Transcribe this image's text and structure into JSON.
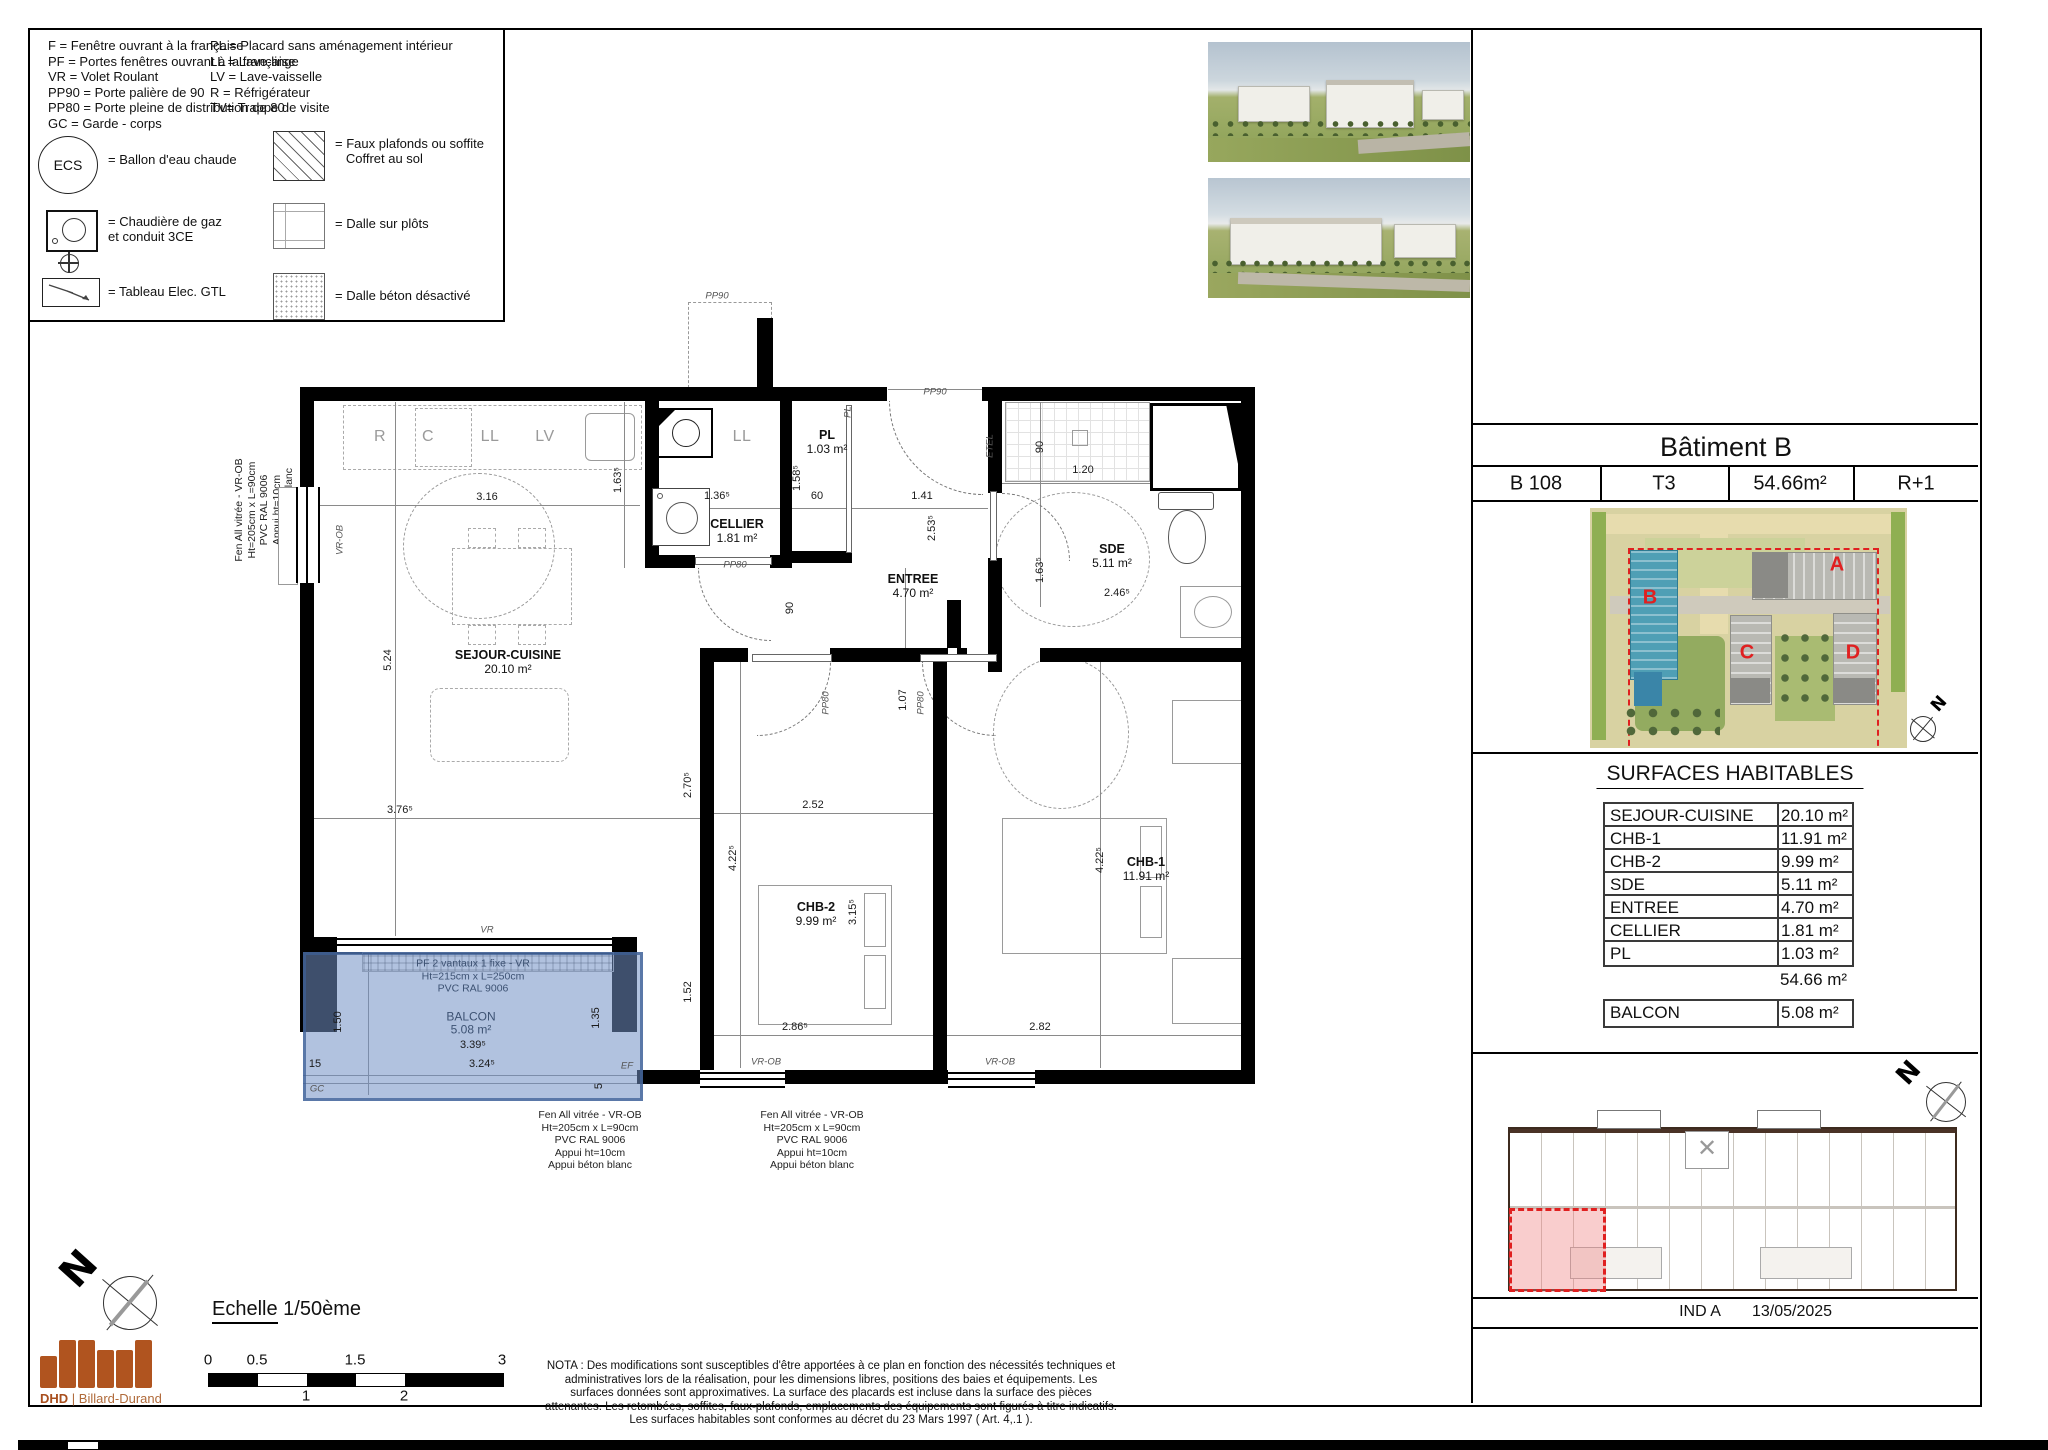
{
  "legend": {
    "abbrev_left": "F = Fenêtre ouvrant à la française\nPF = Portes fenêtres ouvrant à la française\nVR = Volet Roulant\nPP90 = Porte palière de 90\nPP80 = Porte pleine de distribution de 80\nGC = Garde - corps",
    "abbrev_right": "PL = Placard sans aménagement intérieur\nLL = Lave-linge\nLV = Lave-vaisselle\nR = Réfrigérateur\nTV= Trappe de visite",
    "ecs": "ECS",
    "ecs_label": "= Ballon d'eau chaude",
    "boiler_label": "= Chaudière de gaz\net conduit 3CE",
    "elec_label": "= Tableau Elec. GTL",
    "faux_label": "= Faux plafonds ou soffite\n   Coffret au sol",
    "plots_label": "= Dalle sur plôts",
    "beton_label": "= Dalle béton désactivé"
  },
  "plan": {
    "rooms": [
      {
        "name": "SEJOUR-CUISINE",
        "area": "20.10 m²",
        "x": 508,
        "y": 662
      },
      {
        "name": "CELLIER",
        "area": "1.81 m²",
        "x": 737,
        "y": 531
      },
      {
        "name": "PL",
        "area": "1.03 m²",
        "x": 827,
        "y": 442
      },
      {
        "name": "ENTREE",
        "area": "4.70 m²",
        "x": 913,
        "y": 586
      },
      {
        "name": "SDE",
        "area": "5.11 m²",
        "x": 1112,
        "y": 556
      },
      {
        "name": "CHB-2",
        "area": "9.99 m²",
        "x": 816,
        "y": 914
      },
      {
        "name": "CHB-1",
        "area": "11.91 m²",
        "x": 1146,
        "y": 869
      }
    ],
    "dims": [
      {
        "t": "3.16",
        "x": 487,
        "y": 497,
        "r": 0
      },
      {
        "t": "1.63⁵",
        "x": 618,
        "y": 480,
        "r": 1
      },
      {
        "t": "5.24",
        "x": 388,
        "y": 660,
        "r": 1
      },
      {
        "t": "3.76⁵",
        "x": 400,
        "y": 810,
        "r": 0
      },
      {
        "t": "2.70⁵",
        "x": 688,
        "y": 785,
        "r": 1
      },
      {
        "t": "2.52",
        "x": 813,
        "y": 805,
        "r": 0
      },
      {
        "t": "4.22⁵",
        "x": 733,
        "y": 858,
        "r": 1
      },
      {
        "t": "3.15⁵",
        "x": 853,
        "y": 912,
        "r": 1
      },
      {
        "t": "2.86⁵",
        "x": 795,
        "y": 1027,
        "r": 0
      },
      {
        "t": "1.52",
        "x": 688,
        "y": 992,
        "r": 1
      },
      {
        "t": "2.82",
        "x": 1040,
        "y": 1027,
        "r": 0
      },
      {
        "t": "4.22⁵",
        "x": 1100,
        "y": 860,
        "r": 1
      },
      {
        "t": "1.07",
        "x": 903,
        "y": 700,
        "r": 1
      },
      {
        "t": "90",
        "x": 790,
        "y": 608,
        "r": 1
      },
      {
        "t": "90",
        "x": 1040,
        "y": 447,
        "r": 1
      },
      {
        "t": "1.20",
        "x": 1083,
        "y": 470,
        "r": 0
      },
      {
        "t": "1.63⁵",
        "x": 1040,
        "y": 570,
        "r": 1
      },
      {
        "t": "2.46⁵",
        "x": 1117,
        "y": 593,
        "r": 0
      },
      {
        "t": "1.36⁵",
        "x": 717,
        "y": 496,
        "r": 0
      },
      {
        "t": "1.58⁵",
        "x": 797,
        "y": 478,
        "r": 1
      },
      {
        "t": "60",
        "x": 817,
        "y": 496,
        "r": 0
      },
      {
        "t": "1.41",
        "x": 922,
        "y": 496,
        "r": 0
      },
      {
        "t": "2.53⁵",
        "x": 932,
        "y": 528,
        "r": 1
      },
      {
        "t": "1.50",
        "x": 338,
        "y": 1022,
        "r": 1
      },
      {
        "t": "1.35",
        "x": 596,
        "y": 1018,
        "r": 1
      },
      {
        "t": "3.39⁵",
        "x": 473,
        "y": 1045,
        "r": 0
      },
      {
        "t": "3.24⁵",
        "x": 482,
        "y": 1064,
        "r": 0
      },
      {
        "t": "15",
        "x": 315,
        "y": 1064,
        "r": 0
      },
      {
        "t": "5",
        "x": 599,
        "y": 1086,
        "r": 1
      }
    ],
    "tags": [
      {
        "t": "PP90",
        "x": 935,
        "y": 392,
        "r": 0
      },
      {
        "t": "PP90",
        "x": 717,
        "y": 296,
        "r": 0
      },
      {
        "t": "PP80",
        "x": 735,
        "y": 565,
        "r": 0
      },
      {
        "t": "PP80",
        "x": 826,
        "y": 703,
        "r": 1
      },
      {
        "t": "PP80",
        "x": 921,
        "y": 703,
        "r": 1
      },
      {
        "t": "PL",
        "x": 848,
        "y": 412,
        "r": 1
      },
      {
        "t": "VR",
        "x": 487,
        "y": 930,
        "r": 0
      },
      {
        "t": "VR-OB",
        "x": 766,
        "y": 1062,
        "r": 0
      },
      {
        "t": "VR-OB",
        "x": 1000,
        "y": 1062,
        "r": 0
      },
      {
        "t": "VR-OB",
        "x": 340,
        "y": 540,
        "r": 1
      },
      {
        "t": "GC",
        "x": 317,
        "y": 1089,
        "r": 0
      },
      {
        "t": "EF",
        "x": 627,
        "y": 1066,
        "r": 0
      },
      {
        "t": "ETEL",
        "x": 990,
        "y": 446,
        "r": 1
      }
    ],
    "fixtures": [
      {
        "t": "R",
        "x": 380,
        "y": 437
      },
      {
        "t": "C",
        "x": 428,
        "y": 437
      },
      {
        "t": "LL",
        "x": 490,
        "y": 437
      },
      {
        "t": "LV",
        "x": 545,
        "y": 437
      },
      {
        "t": "LL",
        "x": 742,
        "y": 437
      }
    ],
    "window_note": "Fen All vitrée - VR-OB\nHt=205cm x L=90cm\nPVC RAL 9006\nAppui ht=10cm\nAppui béton blanc",
    "balcony_note": "PF 2 vantaux 1 fixe - VR\nHt=215cm x L=250cm\nPVC RAL 9006",
    "balcony_name": "BALCON",
    "balcony_area": "5.08 m²"
  },
  "panel": {
    "title": "Bâtiment B",
    "unit_cells": [
      "B 108",
      "T3",
      "54.66m²",
      "R+1"
    ],
    "surfaces_title": "SURFACES HABITABLES",
    "surfaces": [
      {
        "label": "SEJOUR-CUISINE",
        "value": "20.10 m²"
      },
      {
        "label": "CHB-1",
        "value": "11.91 m²"
      },
      {
        "label": "CHB-2",
        "value": "9.99 m²"
      },
      {
        "label": "SDE",
        "value": "5.11 m²"
      },
      {
        "label": "ENTREE",
        "value": "4.70 m²"
      },
      {
        "label": "CELLIER",
        "value": "1.81 m²"
      },
      {
        "label": "PL",
        "value": "1.03 m²"
      }
    ],
    "total": "54.66 m²",
    "balcon_label": "BALCON",
    "balcon_value": "5.08 m²",
    "site_letters": [
      {
        "t": "A",
        "x": 1837,
        "y": 565
      },
      {
        "t": "B",
        "x": 1650,
        "y": 598
      },
      {
        "t": "C",
        "x": 1747,
        "y": 653
      },
      {
        "t": "D",
        "x": 1853,
        "y": 653
      }
    ],
    "ind": "IND A",
    "date": "13/05/2025",
    "north": "N"
  },
  "footer": {
    "echelle_label": "Echelle",
    "echelle_value": "1/50ème",
    "ticks_top": [
      {
        "t": "0",
        "x": 208
      },
      {
        "t": "0.5",
        "x": 257
      },
      {
        "t": "1.5",
        "x": 355
      },
      {
        "t": "3",
        "x": 502
      }
    ],
    "ticks_bottom": [
      {
        "t": "1",
        "x": 306
      },
      {
        "t": "2",
        "x": 404
      }
    ],
    "nota": "NOTA : Des modifications sont susceptibles d'être apportées à ce plan en fonction des nécessités techniques et administratives lors de la réalisation, pour les dimensions libres, positions des baies et équipements. Les surfaces données sont approximatives. La surface des placards est incluse dans la surface des pièces attenantes. Les retombées, soffites, faux-plafonds, emplacements des équipements sont figurés à titre indicatifs. Les surfaces habitables sont conformes au décret du 23 Mars 1997 ( Art. 4,.1 ).",
    "logo_brand": "DHD",
    "logo_name": "Billard-Durand"
  },
  "colors": {
    "balcony_fill": "#7492c7",
    "accent_red": "#e02020",
    "logo_orange": "#b0541f",
    "site_blue": "#4f9fb5"
  }
}
